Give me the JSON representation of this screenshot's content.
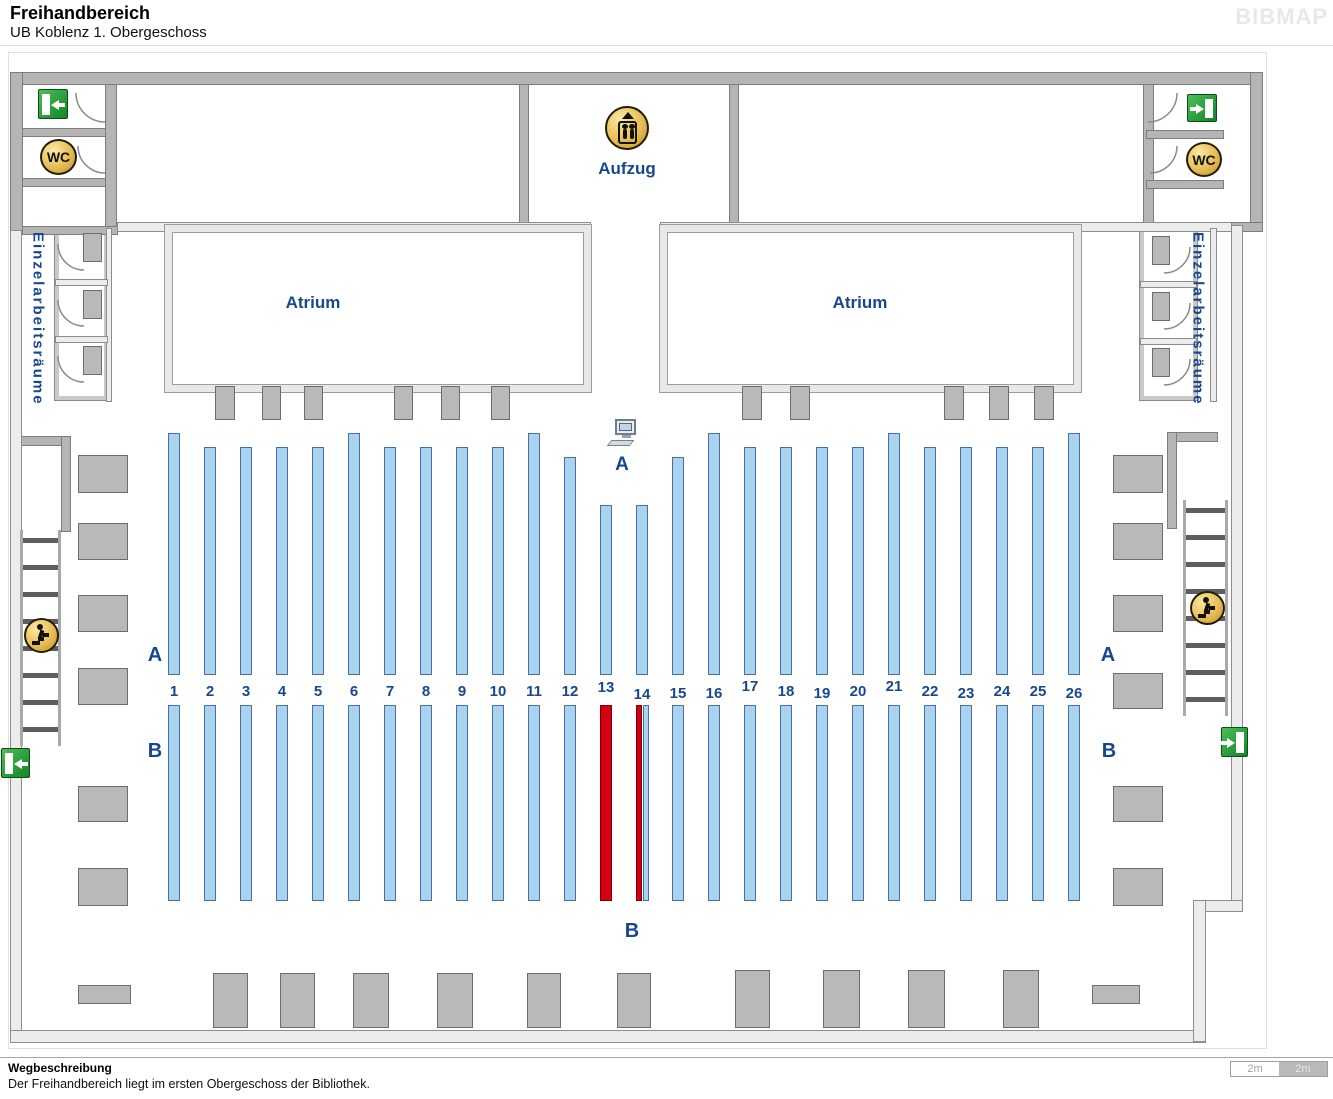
{
  "header": {
    "title": "Freihandbereich",
    "subtitle": "UB Koblenz 1. Obergeschoss",
    "brand": "BIBMAP"
  },
  "footer": {
    "heading": "Wegbeschreibung",
    "text": "Der Freihandbereich liegt im ersten Obergeschoss der Bibliothek.",
    "scale": [
      "2m",
      "2m"
    ]
  },
  "colors": {
    "label_blue": "#17478f",
    "shelf_blue": "#a8d4f2",
    "shelf_highlight_red": "#d40011",
    "wall_gray": "#b5b5b5",
    "exit_green": "#128427",
    "icon_gold": "#e6bd55"
  },
  "map": {
    "walls_solid": [
      [
        10,
        72,
        1253,
        13
      ],
      [
        10,
        72,
        13,
        163
      ],
      [
        1250,
        72,
        13,
        160
      ],
      [
        105,
        84,
        12,
        146
      ],
      [
        1143,
        84,
        11,
        146
      ],
      [
        22,
        128,
        84,
        9
      ],
      [
        22,
        178,
        84,
        9
      ],
      [
        22,
        226,
        96,
        9
      ],
      [
        1146,
        130,
        78,
        9
      ],
      [
        1146,
        180,
        78,
        9
      ],
      [
        1146,
        222,
        117,
        10
      ],
      [
        519,
        84,
        10,
        142
      ],
      [
        729,
        84,
        10,
        142
      ],
      [
        18,
        436,
        53,
        10
      ],
      [
        61,
        436,
        10,
        96
      ],
      [
        1167,
        432,
        51,
        10
      ],
      [
        1167,
        432,
        10,
        97
      ]
    ],
    "walls_light": [
      [
        10,
        230,
        12,
        812
      ],
      [
        10,
        1030,
        1196,
        13
      ],
      [
        1231,
        225,
        12,
        687
      ],
      [
        1193,
        900,
        50,
        12
      ],
      [
        1193,
        900,
        13,
        142
      ],
      [
        117,
        222,
        474,
        10
      ],
      [
        660,
        222,
        572,
        10
      ],
      [
        106,
        228,
        6,
        174
      ],
      [
        1210,
        228,
        7,
        174
      ],
      [
        55,
        279,
        53,
        7
      ],
      [
        55,
        336,
        53,
        7
      ],
      [
        1140,
        281,
        57,
        7
      ],
      [
        1140,
        338,
        57,
        7
      ]
    ],
    "rooms": [
      [
        55,
        228,
        53,
        172
      ],
      [
        1140,
        228,
        57,
        172
      ]
    ],
    "atria": [
      {
        "label": "Atrium",
        "rect": [
          165,
          225,
          426,
          167
        ],
        "label_rect": [
          253,
          291,
          120,
          24
        ]
      },
      {
        "label": "Atrium",
        "rect": [
          660,
          225,
          421,
          167
        ],
        "label_rect": [
          800,
          291,
          120,
          24
        ]
      }
    ],
    "desks": [
      [
        78,
        455,
        50,
        38
      ],
      [
        78,
        523,
        50,
        37
      ],
      [
        78,
        595,
        50,
        37
      ],
      [
        78,
        668,
        50,
        37
      ],
      [
        78,
        786,
        50,
        36
      ],
      [
        78,
        868,
        50,
        38
      ],
      [
        1113,
        455,
        50,
        38
      ],
      [
        1113,
        523,
        50,
        37
      ],
      [
        1113,
        595,
        50,
        37
      ],
      [
        1113,
        673,
        50,
        36
      ],
      [
        1113,
        786,
        50,
        36
      ],
      [
        1113,
        868,
        50,
        38
      ],
      [
        83,
        233,
        19,
        29
      ],
      [
        83,
        290,
        19,
        29
      ],
      [
        83,
        346,
        19,
        29
      ],
      [
        1152,
        236,
        18,
        29
      ],
      [
        1152,
        292,
        18,
        29
      ],
      [
        1152,
        348,
        18,
        29
      ],
      [
        215,
        386,
        20,
        34
      ],
      [
        262,
        386,
        19,
        34
      ],
      [
        304,
        386,
        19,
        34
      ],
      [
        394,
        386,
        19,
        34
      ],
      [
        441,
        386,
        19,
        34
      ],
      [
        491,
        386,
        19,
        34
      ],
      [
        742,
        386,
        20,
        34
      ],
      [
        790,
        386,
        20,
        34
      ],
      [
        944,
        386,
        20,
        34
      ],
      [
        989,
        386,
        20,
        34
      ],
      [
        1034,
        386,
        20,
        34
      ],
      [
        213,
        973,
        35,
        55
      ],
      [
        280,
        973,
        35,
        55
      ],
      [
        353,
        973,
        36,
        55
      ],
      [
        437,
        973,
        36,
        55
      ],
      [
        527,
        973,
        34,
        55
      ],
      [
        617,
        973,
        34,
        55
      ],
      [
        735,
        970,
        35,
        58
      ],
      [
        823,
        970,
        37,
        58
      ],
      [
        908,
        970,
        37,
        58
      ],
      [
        1003,
        970,
        36,
        58
      ],
      [
        1092,
        985,
        48,
        19
      ],
      [
        78,
        985,
        53,
        19
      ]
    ],
    "stairs": [
      [
        20,
        530,
        41,
        216
      ],
      [
        1183,
        500,
        45,
        216
      ]
    ],
    "shelf_bottom_a": 675,
    "shelves_a": [
      {
        "n": 1,
        "x": 168,
        "y": 433
      },
      {
        "n": 2,
        "x": 204,
        "y": 447
      },
      {
        "n": 3,
        "x": 240,
        "y": 447
      },
      {
        "n": 4,
        "x": 276,
        "y": 447
      },
      {
        "n": 5,
        "x": 312,
        "y": 447
      },
      {
        "n": 6,
        "x": 348,
        "y": 433
      },
      {
        "n": 7,
        "x": 384,
        "y": 447
      },
      {
        "n": 8,
        "x": 420,
        "y": 447
      },
      {
        "n": 9,
        "x": 456,
        "y": 447
      },
      {
        "n": 10,
        "x": 492,
        "y": 447
      },
      {
        "n": 11,
        "x": 528,
        "y": 433
      },
      {
        "n": 12,
        "x": 564,
        "y": 457
      },
      {
        "n": 13,
        "x": 600,
        "y": 505,
        "dy": -4
      },
      {
        "n": 14,
        "x": 636,
        "y": 505,
        "dy": 3
      },
      {
        "n": 15,
        "x": 672,
        "y": 457,
        "dy": 2
      },
      {
        "n": 16,
        "x": 708,
        "y": 433,
        "dy": 2
      },
      {
        "n": 17,
        "x": 744,
        "y": 447,
        "dy": -5
      },
      {
        "n": 18,
        "x": 780,
        "y": 447
      },
      {
        "n": 19,
        "x": 816,
        "y": 447,
        "dy": 2
      },
      {
        "n": 20,
        "x": 852,
        "y": 447
      },
      {
        "n": 21,
        "x": 888,
        "y": 433,
        "dy": -5
      },
      {
        "n": 22,
        "x": 924,
        "y": 447
      },
      {
        "n": 23,
        "x": 960,
        "y": 447,
        "dy": 2
      },
      {
        "n": 24,
        "x": 996,
        "y": 447
      },
      {
        "n": 25,
        "x": 1032,
        "y": 447
      },
      {
        "n": 26,
        "x": 1068,
        "y": 433,
        "dy": 2
      }
    ],
    "shelves_b": [
      {
        "x": 168,
        "w": 12,
        "c": "b"
      },
      {
        "x": 204,
        "w": 12,
        "c": "b"
      },
      {
        "x": 240,
        "w": 12,
        "c": "b"
      },
      {
        "x": 276,
        "w": 12,
        "c": "b"
      },
      {
        "x": 312,
        "w": 12,
        "c": "b"
      },
      {
        "x": 348,
        "w": 12,
        "c": "b"
      },
      {
        "x": 384,
        "w": 12,
        "c": "b"
      },
      {
        "x": 420,
        "w": 12,
        "c": "b"
      },
      {
        "x": 456,
        "w": 12,
        "c": "b"
      },
      {
        "x": 492,
        "w": 12,
        "c": "b"
      },
      {
        "x": 528,
        "w": 12,
        "c": "b"
      },
      {
        "x": 564,
        "w": 12,
        "c": "b"
      },
      {
        "x": 600,
        "w": 12,
        "c": "r",
        "n": 13
      },
      {
        "x": 636,
        "w": 6,
        "c": "r",
        "n": 14
      },
      {
        "x": 643,
        "w": 6,
        "c": "b",
        "n": 14
      },
      {
        "x": 672,
        "w": 12,
        "c": "b"
      },
      {
        "x": 708,
        "w": 12,
        "c": "b"
      },
      {
        "x": 744,
        "w": 12,
        "c": "b"
      },
      {
        "x": 780,
        "w": 12,
        "c": "b"
      },
      {
        "x": 816,
        "w": 12,
        "c": "b"
      },
      {
        "x": 852,
        "w": 12,
        "c": "b"
      },
      {
        "x": 888,
        "w": 12,
        "c": "b"
      },
      {
        "x": 924,
        "w": 12,
        "c": "b"
      },
      {
        "x": 960,
        "w": 12,
        "c": "b"
      },
      {
        "x": 996,
        "w": 12,
        "c": "b"
      },
      {
        "x": 1032,
        "w": 12,
        "c": "b"
      },
      {
        "x": 1068,
        "w": 12,
        "c": "b"
      }
    ],
    "labels": [
      {
        "name": "aufzug-label",
        "text": "Aufzug",
        "rect": [
          577,
          158,
          100,
          22
        ],
        "size": 17
      },
      {
        "name": "section-a-center-label",
        "text": "A",
        "rect": [
          608,
          452,
          28,
          26
        ],
        "size": 19
      },
      {
        "name": "section-a-left-label",
        "text": "A",
        "rect": [
          141,
          641,
          28,
          28
        ],
        "size": 20
      },
      {
        "name": "section-a-right-label",
        "text": "A",
        "rect": [
          1095,
          641,
          26,
          28
        ],
        "size": 20
      },
      {
        "name": "section-b-left-label",
        "text": "B",
        "rect": [
          141,
          737,
          28,
          28
        ],
        "size": 20
      },
      {
        "name": "section-b-right-label",
        "text": "B",
        "rect": [
          1096,
          737,
          26,
          28
        ],
        "size": 20
      },
      {
        "name": "section-b-center-label",
        "text": "B",
        "rect": [
          618,
          917,
          28,
          28
        ],
        "size": 20
      },
      {
        "name": "einzelarbeitsraeume-left-label",
        "text": "Einzelarbeitsräume",
        "rect": [
          27,
          232,
          22,
          340
        ],
        "size": 15,
        "vertical": true
      },
      {
        "name": "einzelarbeitsraeume-right-label",
        "text": "Einzelarbeitsräume",
        "rect": [
          1187,
          232,
          22,
          345
        ],
        "size": 15,
        "vertical": true
      }
    ],
    "arcs": [
      [
        76,
        93,
        29,
        "bl"
      ],
      [
        78,
        146,
        27,
        "bl"
      ],
      [
        1148,
        93,
        29,
        "br"
      ],
      [
        1150,
        146,
        27,
        "br"
      ],
      [
        58,
        244,
        26,
        "bl"
      ],
      [
        58,
        300,
        26,
        "bl"
      ],
      [
        58,
        356,
        26,
        "bl"
      ],
      [
        1164,
        247,
        26,
        "br"
      ],
      [
        1164,
        303,
        26,
        "br"
      ],
      [
        1164,
        359,
        26,
        "br"
      ]
    ],
    "icons": [
      {
        "type": "exit",
        "dir": "left",
        "rect": [
          38,
          89,
          30,
          30
        ]
      },
      {
        "type": "wc",
        "label": "WC",
        "rect": [
          40,
          139,
          37,
          36
        ]
      },
      {
        "type": "exit",
        "dir": "right",
        "rect": [
          1187,
          94,
          30,
          28
        ]
      },
      {
        "type": "wc",
        "label": "WC",
        "rect": [
          1186,
          142,
          36,
          35
        ]
      },
      {
        "type": "lift",
        "rect": [
          605,
          106,
          44,
          44
        ]
      },
      {
        "type": "pc",
        "rect": [
          608,
          419,
          34,
          30
        ]
      },
      {
        "type": "stairs-person",
        "rect": [
          24,
          618,
          35,
          35
        ]
      },
      {
        "type": "stairs-person",
        "rect": [
          1190,
          591,
          35,
          34
        ]
      },
      {
        "type": "exit",
        "dir": "left",
        "rect": [
          1,
          748,
          29,
          30
        ]
      },
      {
        "type": "exit",
        "dir": "right",
        "rect": [
          1221,
          727,
          27,
          30
        ]
      }
    ]
  }
}
